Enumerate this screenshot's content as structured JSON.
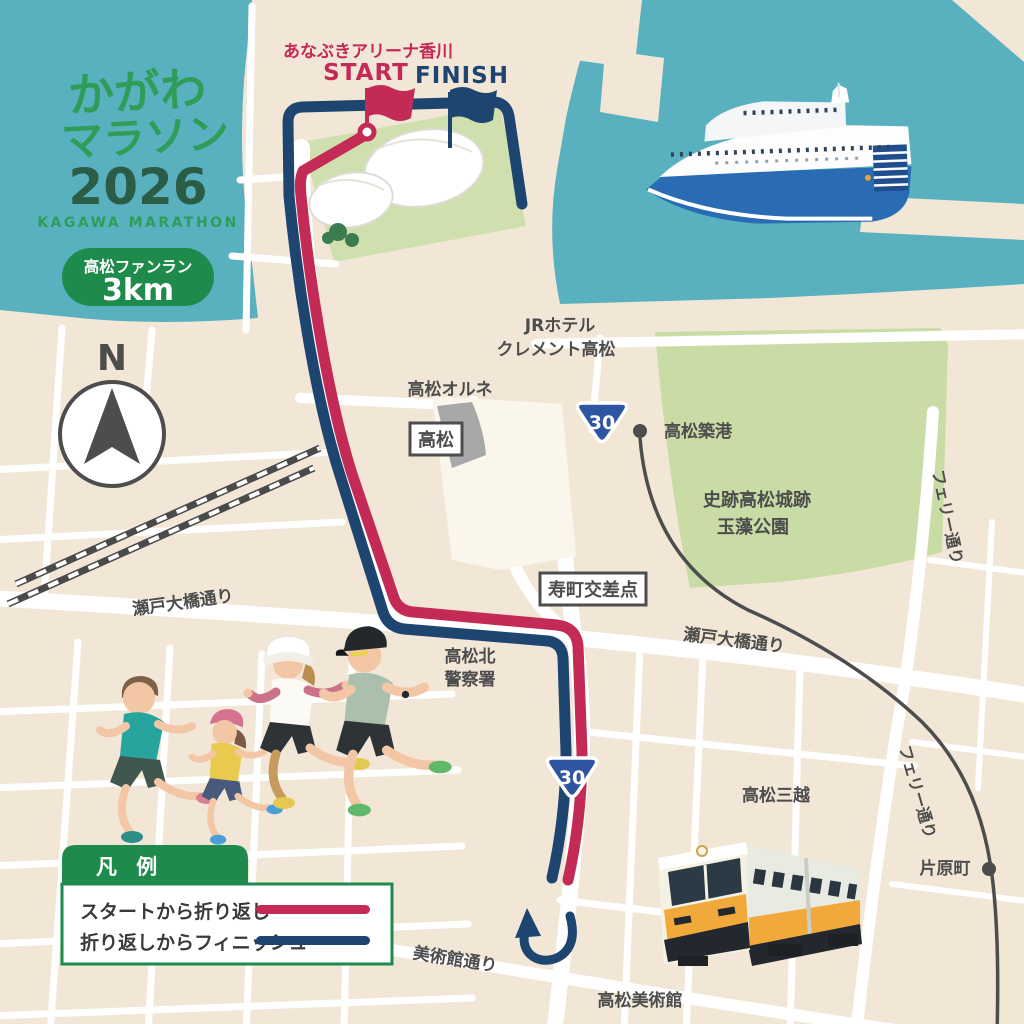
{
  "logo": {
    "title_line1": "かがわ",
    "title_line2": "マラソン",
    "year": "2026",
    "subtitle": "KAGAWA MARATHON"
  },
  "badge": {
    "label": "高松ファンラン",
    "distance": "3km"
  },
  "compass": {
    "north": "N"
  },
  "course": {
    "venue": "あなぶきアリーナ香川",
    "start_label": "START",
    "finish_label": "FINISH",
    "route_shield": "30"
  },
  "legend": {
    "title": "凡 例",
    "items": [
      {
        "label": "スタートから折り返し",
        "color": "#c42a56"
      },
      {
        "label": "折り返しからフィニッシュ",
        "color": "#1e4470"
      }
    ]
  },
  "labels": {
    "jr_hotel_1": "JRホテル",
    "jr_hotel_2": "クレメント高松",
    "orune": "高松オルネ",
    "takamatsu_station": "高松",
    "takamatsu_chikko": "高松築港",
    "tamamo_1": "史跡高松城跡",
    "tamamo_2": "玉藻公園",
    "kotobuki_crossing": "寿町交差点",
    "seto_ohashi_street_west": "瀬戸大橋通り",
    "seto_ohashi_street_east": "瀬戸大橋通り",
    "police_1": "高松北",
    "police_2": "警察署",
    "ferry_street_north": "フェリー通り",
    "ferry_street_south": "フェリー通り",
    "mitsukoshi": "高松三越",
    "kataharamachi": "片原町",
    "museum_street": "美術館通り",
    "museum": "高松美術館"
  },
  "colors": {
    "water": "#59b1c0",
    "land": "#f2e7d6",
    "park": "#cadca5",
    "arena_green": "#cfe0ae",
    "route_outbound": "#c42a56",
    "route_return": "#1e4470",
    "shield": "#2e55a2",
    "legend_green": "#1e8a4c",
    "logo_green": "#2f9d58",
    "logo_dark_green": "#2a5c46",
    "label_gray": "#4d4d4d"
  }
}
